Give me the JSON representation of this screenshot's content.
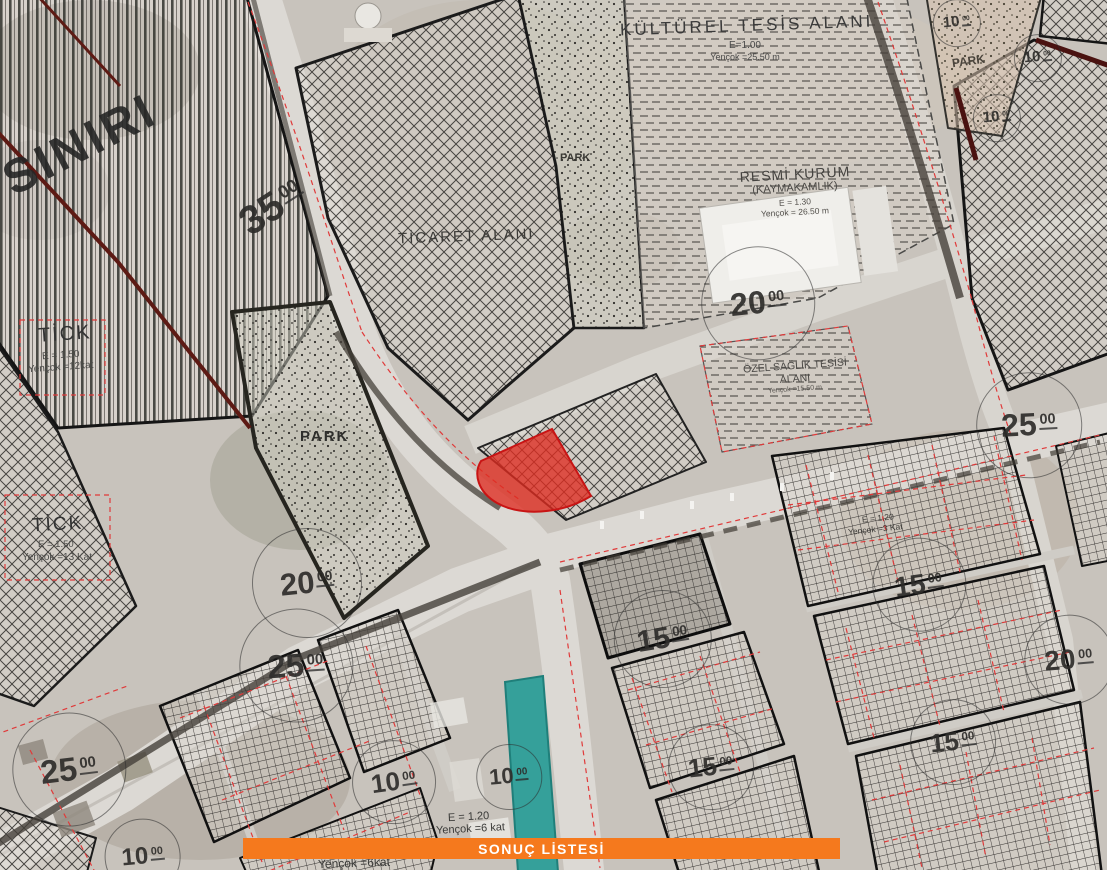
{
  "colors": {
    "accent_orange": "#F5791D",
    "parcel_red": "#DF2B20",
    "canal_teal": "#35A09A",
    "plan_line_black": "#1B1B1B",
    "plan_line_red": "#E03A3A"
  },
  "button": {
    "label": "SONUÇ LİSTESİ"
  },
  "zones": {
    "sinir_label": "SINIRI",
    "kulturel": {
      "title": "KÜLTÜREL TESİS ALANI",
      "e": "E=1.00",
      "yencok": "Yençok =25.50 m"
    },
    "resmi": {
      "title": "RESMİ KURUM",
      "subtitle": "(KAYMAKAMLIK)",
      "e": "E = 1.30",
      "yencok": "Yençok = 26.50 m"
    },
    "ticaret": {
      "title": "TİCARET ALANI"
    },
    "ozel_saglik": {
      "line1": "ÖZEL SAĞLIK TESİSİ",
      "line2": "ALANI",
      "yencok": "Yençok =15.50 m"
    },
    "park_left": "PARK",
    "park_strip": "PARK",
    "park_ne": "PARK",
    "tick_upper": {
      "title": "TİCK",
      "e": "E = 1.50",
      "yencok": "Yençok =12kat"
    },
    "tick_lower": {
      "title": "TİCK",
      "e": "E = 1.50",
      "yencok": "Yençok =13 Kat"
    },
    "bottom_e": "E = 1.20",
    "bottom_yencok": "Yençok =6 kat",
    "bottom_yencok2": "Yençok =6kat",
    "right_parcel": {
      "e": "E = 1.20",
      "yencok": "Yençok =3 Kat"
    }
  },
  "road_widths": [
    {
      "main": "35",
      "sup": "00"
    },
    {
      "main": "20",
      "sup": "00"
    },
    {
      "main": "25",
      "sup": "00"
    },
    {
      "main": "10",
      "sup": "00"
    },
    {
      "main": "10",
      "sup": "00"
    },
    {
      "main": "10",
      "sup": "00"
    },
    {
      "main": "20",
      "sup": "00"
    },
    {
      "main": "25",
      "sup": "00"
    },
    {
      "main": "25",
      "sup": "00"
    },
    {
      "main": "15",
      "sup": "00"
    },
    {
      "main": "15",
      "sup": "00"
    },
    {
      "main": "20",
      "sup": "00"
    },
    {
      "main": "15",
      "sup": "00"
    },
    {
      "main": "15",
      "sup": "00"
    },
    {
      "main": "10",
      "sup": "00"
    },
    {
      "main": "10",
      "sup": "00"
    },
    {
      "main": "10",
      "sup": "00"
    }
  ]
}
